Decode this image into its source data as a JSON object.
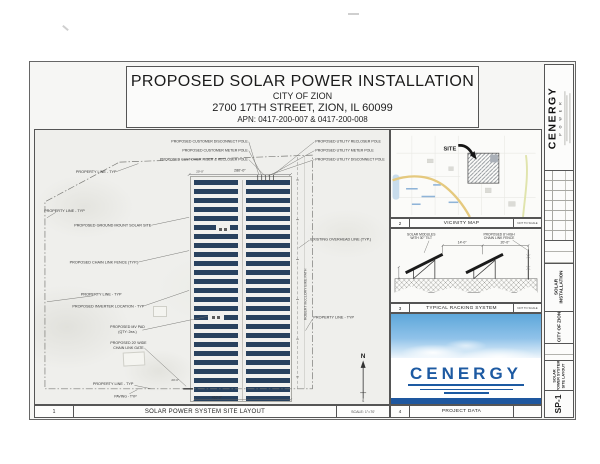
{
  "header": {
    "title": "PROPOSED SOLAR POWER INSTALLATION",
    "subtitle": "CITY OF ZION",
    "address": "2700 17TH STREET, ZION, IL 60099",
    "apn": "APN: 0417-200-007 & 0417-200-008"
  },
  "plan": {
    "number": "1",
    "title": "SOLAR POWER SYSTEM SITE LAYOUT",
    "scale": "SCALE: 1\"=70'",
    "north_letter": "N",
    "south_letter": "S",
    "labels": {
      "property_line": "PROPERTY LINE - TYP",
      "ground_mount": "PROPOSED GROUND MOUNT SOLAR SITE",
      "chain_fence": "PROPOSED CHAIN LINK FENCE (TYP.)",
      "inverter": "PROPOSED INVERTER LOCATION - TYP",
      "mv_pad_line1": "PROPOSED MV PAD",
      "mv_pad_line2": "(QTY: 2ea.)",
      "gate_line1": "PROPOSED 20' WIDE",
      "gate_line2": "CHAIN LINK GATE",
      "paving": "PAVING - TYP",
      "overhead": "EXISTING OVERHEAD LINE (TYP.)",
      "bike_path": "ROBERT McCLORY BIKE PATH",
      "cust_disconnect": "PROPOSED CUSTOMER DISCONNECT POLE",
      "cust_meter": "PROPOSED CUSTOMER METER POLE",
      "cust_riser": "PROPOSED CUSTOMER RISER & RECLOSER POLE",
      "util_recloser": "PROPOSED UTILITY RECLOSER POLE",
      "util_meter": "PROPOSED UTILITY METER POLE",
      "util_disconnect": "PROPOSED UTILITY DISCONNECT POLE"
    },
    "dims": {
      "array_width": "280'-0\"",
      "edge": "20'-0\"",
      "gate": "20'-0\"",
      "south": "410'-0\""
    }
  },
  "vicinity": {
    "number": "2",
    "title": "VICINITY MAP",
    "scale": "NOT TO SCALE",
    "site_label": "SITE"
  },
  "racking": {
    "number": "3",
    "title": "TYPICAL RACKING SYSTEM",
    "scale": "NOT TO SCALE",
    "modules_line1": "SOLAR MODULES",
    "modules_line2": "WITH 30° TILT",
    "fence_line1": "PROPOSED 8' HIGH",
    "fence_line2": "CHAIN LINK FENCE",
    "dim_spacing": "14'-0\"",
    "dim_fence": "20'-0\""
  },
  "project": {
    "number": "4",
    "title": "PROJECT DATA",
    "logo_text": "CENERGY"
  },
  "strip": {
    "brand": "CENERGY",
    "brand_sub": "P O W E R",
    "project_line1": "SOLAR",
    "project_line2": "INSTALLATION",
    "client": "CITY OF ZION",
    "sheet_line1": "SOLAR",
    "sheet_line2": "POWER SYSTEM",
    "sheet_line3": "SITE LAYOUT",
    "sheet_number": "SP-1"
  }
}
